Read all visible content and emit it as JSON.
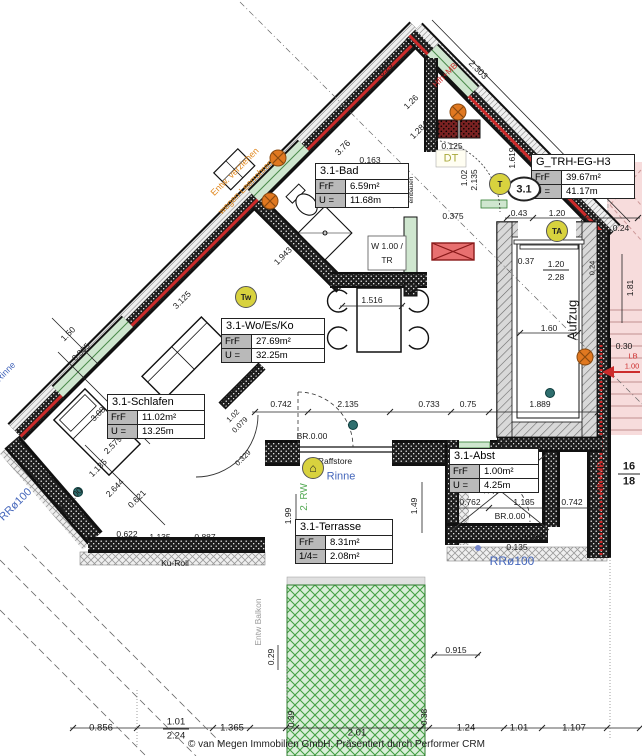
{
  "meta": {
    "footer": "© van Megen Immobilien GmbH. Präsentiert durch Performer CRM"
  },
  "rooms": {
    "bad": {
      "name": "3.1-Bad",
      "k1": "FrF",
      "v1": "6.59m²",
      "k2": "U =",
      "v2": "11.68m"
    },
    "trh": {
      "name": "G_TRH-EG-H3",
      "k1": "FrF",
      "v1": "39.67m²",
      "k2": "U =",
      "v2": "41.17m"
    },
    "wo": {
      "name": "3.1-Wo/Es/Ko",
      "k1": "FrF",
      "v1": "27.69m²",
      "k2": "U =",
      "v2": "32.25m"
    },
    "schlafen": {
      "name": "3.1-Schlafen",
      "k1": "FrF",
      "v1": "11.02m²",
      "k2": "U =",
      "v2": "13.25m"
    },
    "terrasse": {
      "name": "3.1-Terrasse",
      "k1": "FrF",
      "v1": "8.31m²",
      "k2": "1/4=",
      "v2": "2.08m²"
    },
    "abst": {
      "name": "3.1-Abst",
      "k1": "FrF",
      "v1": "1.00m²",
      "k2": "U =",
      "v2": "4.25m"
    }
  },
  "badges": {
    "unit": "3.1",
    "t": "T",
    "ta": "TA",
    "tw": "Tw",
    "house": "⌂"
  },
  "colors": {
    "accent_red": "#cc2b2b",
    "orange": "#e08820",
    "blue": "#4466bb",
    "green": "#55aa55",
    "yellow": "#d8d23e",
    "pink_stairs": "#f7dcdc",
    "label_gray": "#b9b9b9"
  },
  "labels": [
    {
      "t": "2.303",
      "x": 478,
      "y": 70,
      "r": 45
    },
    {
      "t": "3.76",
      "x": 343,
      "y": 148,
      "r": -45
    },
    {
      "t": "0.25",
      "x": 386,
      "y": 70,
      "r": -45,
      "s": 8
    },
    {
      "t": "1.26",
      "x": 411,
      "y": 102,
      "r": -45,
      "s": 8.5
    },
    {
      "t": "1.284",
      "x": 419,
      "y": 130,
      "r": -45,
      "s": 8.5
    },
    {
      "t": "0.125",
      "x": 452,
      "y": 146,
      "s": 8.5
    },
    {
      "t": "DT",
      "x": 451,
      "y": 159,
      "c": "#a8a83a",
      "s": 11,
      "n": "dt-label"
    },
    {
      "t": "0.163",
      "x": 370,
      "y": 160,
      "s": 8.5
    },
    {
      "t": "1.02",
      "x": 381,
      "y": 196,
      "r": -90,
      "s": 8.5
    },
    {
      "t": "2.135",
      "x": 391,
      "y": 198,
      "r": -90,
      "s": 8.5
    },
    {
      "t": "1.02",
      "x": 464,
      "y": 178,
      "r": -90,
      "s": 8.5
    },
    {
      "t": "2.135",
      "x": 474,
      "y": 180,
      "r": -90,
      "s": 8.5
    },
    {
      "t": "0.375",
      "x": 453,
      "y": 216,
      "s": 8.5
    },
    {
      "t": "1.619",
      "x": 512,
      "y": 158,
      "r": -90,
      "s": 8.5
    },
    {
      "t": "OK-KPS/S",
      "x": 404,
      "y": 188,
      "r": -90,
      "s": 6.5
    },
    {
      "t": "einbauen",
      "x": 412,
      "y": 190,
      "r": -90,
      "s": 6.5
    },
    {
      "t": "Hfh+MB",
      "x": 445,
      "y": 75,
      "r": -45,
      "c": "#cc2b2b",
      "s": 8.5,
      "n": "hfh-mb-label"
    },
    {
      "t": "Entw. verziehen",
      "x": 235,
      "y": 172,
      "r": -45,
      "c": "#e08820",
      "s": 9,
      "n": "entw-note"
    },
    {
      "t": "wegen Leerrohren",
      "x": 246,
      "y": 187,
      "r": -45,
      "c": "#e08820",
      "s": 9,
      "n": "entw-note"
    },
    {
      "t": "W 1.00 /",
      "x": 387,
      "y": 246,
      "s": 8.5,
      "n": "window-tag"
    },
    {
      "t": "TR",
      "x": 387,
      "y": 260,
      "s": 8.5,
      "n": "window-tag"
    },
    {
      "t": "0.43",
      "x": 519,
      "y": 213,
      "s": 8.5
    },
    {
      "t": "1.20",
      "x": 557,
      "y": 213,
      "s": 8.5
    },
    {
      "t": "0.24",
      "x": 621,
      "y": 228,
      "s": 8.5
    },
    {
      "t": "0.37",
      "x": 526,
      "y": 261,
      "s": 8.5
    },
    {
      "t": "1.20",
      "x": 556,
      "y": 264,
      "s": 8.5
    },
    {
      "t": "2.28",
      "x": 556,
      "y": 277,
      "s": 8.5
    },
    {
      "t": "1.81",
      "x": 630,
      "y": 288,
      "r": -90,
      "s": 8.5
    },
    {
      "t": "0.24",
      "x": 592,
      "y": 268,
      "r": -90,
      "s": 7.5
    },
    {
      "t": "Aufzug",
      "x": 572,
      "y": 320,
      "r": -90,
      "s": 13,
      "n": "elevator-label"
    },
    {
      "t": "1.60",
      "x": 549,
      "y": 328,
      "s": 8.5
    },
    {
      "t": "0.30",
      "x": 624,
      "y": 346,
      "s": 8.5
    },
    {
      "t": "LB",
      "x": 633,
      "y": 356,
      "c": "#cc2b2b",
      "s": 7.5
    },
    {
      "t": "1.00",
      "x": 632,
      "y": 366,
      "c": "#cc2b2b",
      "s": 7.5
    },
    {
      "t": "16",
      "x": 629,
      "y": 467,
      "s": 11,
      "b": 1,
      "n": "stair-count"
    },
    {
      "t": "18",
      "x": 629,
      "y": 482,
      "s": 11,
      "b": 1,
      "n": "stair-count"
    },
    {
      "t": "Hfh+MB",
      "x": 601,
      "y": 478,
      "r": -90,
      "c": "#cc2b2b",
      "s": 9,
      "n": "hfh-mb-label"
    },
    {
      "t": "0.742",
      "x": 281,
      "y": 404,
      "s": 8.5
    },
    {
      "t": "2.135",
      "x": 348,
      "y": 404,
      "s": 8.5
    },
    {
      "t": "0.733",
      "x": 429,
      "y": 404,
      "s": 8.5
    },
    {
      "t": "0.75",
      "x": 468,
      "y": 404,
      "s": 8.5
    },
    {
      "t": "1.889",
      "x": 540,
      "y": 404,
      "s": 8.5
    },
    {
      "t": "BR.0.00",
      "x": 312,
      "y": 436,
      "s": 8.5
    },
    {
      "t": "BR.0.00",
      "x": 510,
      "y": 516,
      "s": 8.5
    },
    {
      "t": "BR.0.00",
      "x": 70,
      "y": 500,
      "r": -45,
      "s": 8.5
    },
    {
      "t": "1.516",
      "x": 372,
      "y": 300,
      "s": 8.5
    },
    {
      "t": "3.125",
      "x": 182,
      "y": 300,
      "r": -45,
      "s": 8.5
    },
    {
      "t": "1.943",
      "x": 283,
      "y": 256,
      "r": -45,
      "s": 8.5
    },
    {
      "t": "1.50",
      "x": 68,
      "y": 334,
      "r": -45,
      "s": 8.5
    },
    {
      "t": "0.385",
      "x": 81,
      "y": 352,
      "r": -45,
      "s": 8.5
    },
    {
      "t": "3.08",
      "x": 98,
      "y": 414,
      "r": -45,
      "s": 8.5
    },
    {
      "t": "2.579",
      "x": 113,
      "y": 445,
      "r": -45,
      "s": 8.5
    },
    {
      "t": "1.135",
      "x": 98,
      "y": 468,
      "r": -45,
      "s": 8.5
    },
    {
      "t": "1.02",
      "x": 233,
      "y": 416,
      "r": -45,
      "s": 7.5
    },
    {
      "t": "0.079",
      "x": 240,
      "y": 425,
      "r": -45,
      "s": 7.5
    },
    {
      "t": "0.329",
      "x": 243,
      "y": 458,
      "r": -45,
      "s": 7.5
    },
    {
      "t": "2.644",
      "x": 115,
      "y": 488,
      "r": -45,
      "s": 8.5
    },
    {
      "t": "0.621",
      "x": 137,
      "y": 499,
      "r": -45,
      "s": 8.5
    },
    {
      "t": "0.622",
      "x": 127,
      "y": 534,
      "s": 8.5
    },
    {
      "t": "1.135",
      "x": 160,
      "y": 537,
      "s": 8.5
    },
    {
      "t": "0.887",
      "x": 205,
      "y": 537,
      "s": 8.5
    },
    {
      "t": "Ku-Roll",
      "x": 175,
      "y": 563,
      "s": 8.5,
      "n": "ku-roll-label"
    },
    {
      "t": "Ku-Roll",
      "x": 530,
      "y": 537,
      "s": 8.5,
      "n": "ku-roll-label"
    },
    {
      "t": "0.135",
      "x": 517,
      "y": 547,
      "s": 8.5
    },
    {
      "t": "RRø100",
      "x": 512,
      "y": 561,
      "c": "#4466bb",
      "s": 12,
      "n": "rainpipe-label"
    },
    {
      "t": "RRø100",
      "x": 16,
      "y": 505,
      "r": -45,
      "c": "#4466bb",
      "s": 11,
      "n": "rainpipe-label"
    },
    {
      "t": "Rinne",
      "x": 6,
      "y": 372,
      "r": -45,
      "c": "#4466bb",
      "s": 9,
      "n": "gutter-label"
    },
    {
      "t": "Rinne",
      "x": 341,
      "y": 477,
      "c": "#4466bb",
      "s": 11,
      "n": "gutter-label"
    },
    {
      "t": "Raffstore",
      "x": 335,
      "y": 461,
      "s": 8.5,
      "n": "raffstore-label"
    },
    {
      "t": "2. RW",
      "x": 305,
      "y": 497,
      "r": -90,
      "c": "#55aa55",
      "s": 10,
      "n": "rw-label"
    },
    {
      "t": "1.99",
      "x": 288,
      "y": 516,
      "r": -90,
      "s": 8.5
    },
    {
      "t": "1.49",
      "x": 414,
      "y": 506,
      "r": -90,
      "s": 8.5
    },
    {
      "t": "0.762",
      "x": 470,
      "y": 502,
      "s": 8.5
    },
    {
      "t": "1.135",
      "x": 524,
      "y": 502,
      "s": 8.5
    },
    {
      "t": "0.742",
      "x": 572,
      "y": 502,
      "s": 8.5
    },
    {
      "t": "0.125",
      "x": 510,
      "y": 446,
      "s": 8
    },
    {
      "t": "1.00",
      "x": 486,
      "y": 487,
      "r": -90,
      "s": 7.5
    },
    {
      "t": "2.02",
      "x": 495,
      "y": 487,
      "r": -90,
      "s": 7.5
    },
    {
      "t": "Entw Balkon",
      "x": 258,
      "y": 622,
      "r": -90,
      "c": "#9a9a9a",
      "s": 8.5,
      "n": "balkon-note"
    },
    {
      "t": "0.29",
      "x": 271,
      "y": 657,
      "r": -90,
      "s": 8.5
    },
    {
      "t": "0.915",
      "x": 456,
      "y": 650,
      "s": 8.5
    },
    {
      "t": "0.39",
      "x": 291,
      "y": 719,
      "r": -90,
      "s": 8.5
    },
    {
      "t": "2.01",
      "x": 357,
      "y": 733,
      "s": 9.5
    },
    {
      "t": "0.38",
      "x": 424,
      "y": 717,
      "r": -90,
      "s": 8.5
    },
    {
      "t": "0.856",
      "x": 101,
      "y": 728,
      "s": 9.5
    },
    {
      "t": "1.01",
      "x": 176,
      "y": 722,
      "s": 9.5
    },
    {
      "t": "2.24",
      "x": 176,
      "y": 736,
      "s": 9.5
    },
    {
      "t": "1.365",
      "x": 232,
      "y": 728,
      "s": 9.5
    },
    {
      "t": "1.24",
      "x": 466,
      "y": 728,
      "s": 9.5
    },
    {
      "t": "1.01",
      "x": 519,
      "y": 728,
      "s": 9.5
    },
    {
      "t": "1.107",
      "x": 574,
      "y": 728,
      "s": 9.5
    }
  ]
}
